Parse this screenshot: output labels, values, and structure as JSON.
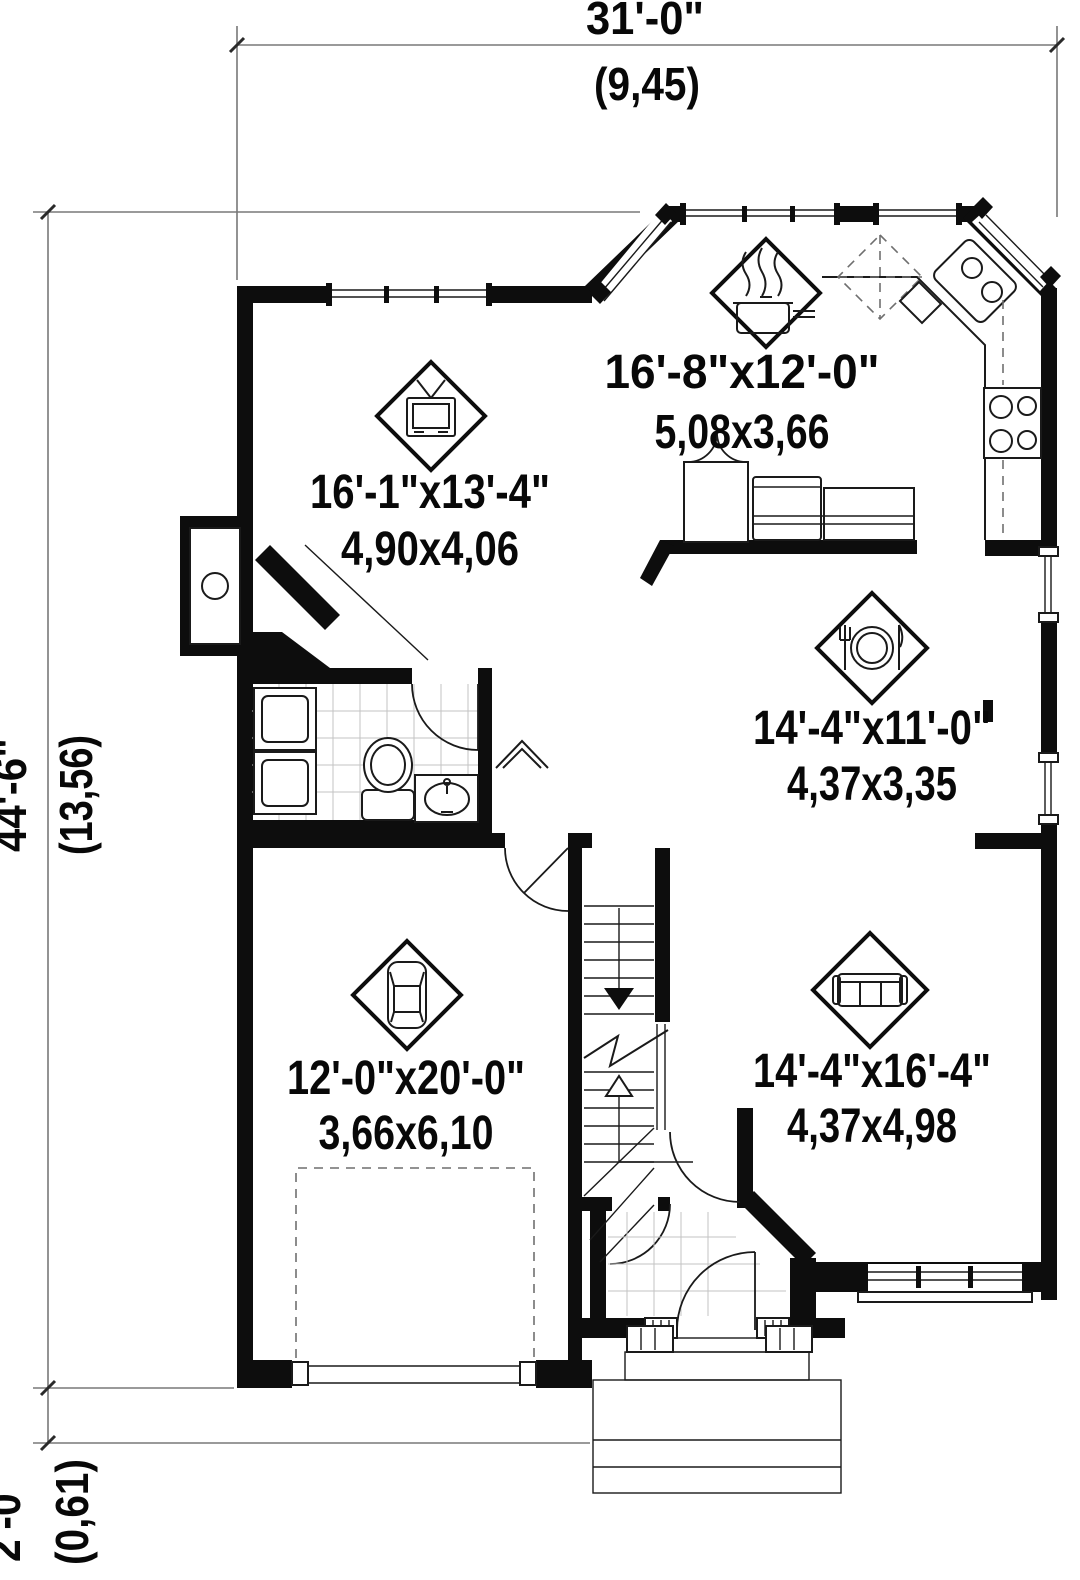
{
  "plan": {
    "type": "architectural-floor-plan",
    "dim_top": {
      "imperial": "31'-0\"",
      "metric": "(9,45)"
    },
    "dim_left": {
      "imperial": "44'-6\"",
      "metric": "(13,56)"
    },
    "dim_porch": {
      "imperial": "2'-0\"",
      "metric": "(0,61)"
    },
    "rooms": {
      "living": {
        "icon": "tv-icon",
        "imperial": "16'-1\"x13'-4\"",
        "metric": "4,90x4,06"
      },
      "kitchen": {
        "icon": "cooking-pot-icon",
        "imperial": "16'-8\"x12'-0\"",
        "metric": "5,08x3,66"
      },
      "dining": {
        "icon": "place-setting-icon",
        "imperial": "14'-4\"x11'-0\"",
        "metric": "4,37x3,35"
      },
      "family": {
        "icon": "sofa-icon",
        "imperial": "14'-4\"x16'-4\"",
        "metric": "4,37x4,98"
      },
      "garage": {
        "icon": "car-icon",
        "imperial": "12'-0\"x20'-0\"",
        "metric": "3,66x6,10"
      }
    },
    "colors": {
      "walls": "#0d0d0d",
      "lines": "#1a1a1a",
      "dimension_lines": "#787878",
      "tile": "#c3c3c3",
      "background": "#ffffff"
    }
  }
}
